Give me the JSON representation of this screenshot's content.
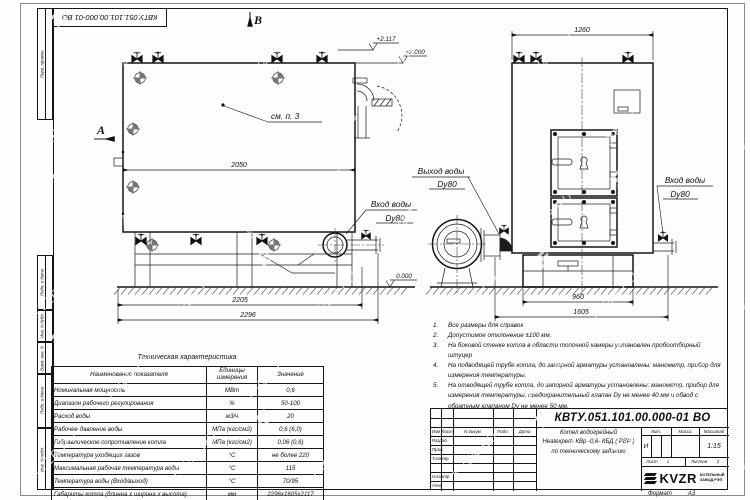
{
  "watermark": {
    "text": "KVZR.RU"
  },
  "frame": {
    "top_stamp": "КВТУ.051.101.00.000-01 ВО",
    "margin_stamps": [
      {
        "label": "Перв. примен."
      },
      {
        "label": "Подп. и дата"
      },
      {
        "label": "Инв. N дубл."
      },
      {
        "label": "Взам. инв. N"
      },
      {
        "label": "Подп. и дата"
      },
      {
        "label": "Инв. N подл."
      }
    ],
    "format_label": "Формат",
    "format_value": "А3"
  },
  "drawing": {
    "view_arrow_a": "А",
    "view_arrow_b": "В",
    "see_note": "см. п. 3",
    "elev_top": "+2.117",
    "elev_mid": "+2.000",
    "elev_zero": "0.000",
    "dims": {
      "d2050": "2050",
      "d2205": "2205",
      "d2296": "2296",
      "d1260": "1260",
      "d960": "960",
      "d1605": "1605"
    },
    "labels": {
      "outlet_line1": "Выход воды",
      "outlet_line2": "Dy80",
      "inlet_left_line1": "Вход воды",
      "inlet_left_line2": "Dy80",
      "inlet_right_line1": "Вход воды",
      "inlet_right_line2": "Dy80"
    }
  },
  "tech_table": {
    "title": "Техническая характеристика",
    "headers": {
      "name": "Наименование показателя",
      "units": "Единицы измерения",
      "value": "Значение"
    },
    "rows": [
      {
        "name": "Номинальная мощность",
        "units": "МВт",
        "value": "0,6"
      },
      {
        "name": "Диапазон рабочего регулирования",
        "units": "%",
        "value": "50-100"
      },
      {
        "name": "Расход воды",
        "units": "м3/ч",
        "value": "20"
      },
      {
        "name": "Рабочее давление воды",
        "units": "МПа (кгс/см2)",
        "value": "0,6 (6,0)"
      },
      {
        "name": "Гидравлическое сопротивление котла",
        "units": "МПа (кгс/см2)",
        "value": "0,06 (0,6)"
      },
      {
        "name": "Температура уходящих газов",
        "units": "°С",
        "value": "не более 220"
      },
      {
        "name": "Максимальная рабочая температура воды",
        "units": "°С",
        "value": "115"
      },
      {
        "name": "Температура воды (Вход/выход)",
        "units": "°С",
        "value": "70/95"
      },
      {
        "name": "Габариты котла (длинна х ширина х высота)",
        "units": "мм",
        "value": "2296х1605х2117"
      }
    ]
  },
  "notes": [
    {
      "n": "1.",
      "text": "Все размеры для справок"
    },
    {
      "n": "2.",
      "text": "Допустимое отклонение  ±100 мм."
    },
    {
      "n": "3.",
      "text": "На боковой стенке котла в области топочной камеры установлен пробоотборный штуцер"
    },
    {
      "n": "4.",
      "text": "На подводящей трубе котла, до запорной арматуры установлены: манометр, прибор для измерения температуры."
    },
    {
      "n": "5.",
      "text": "На отводящей трубе котла, до запорной арматуры установлены: манометр, прибор для измерения температуры, предохранительный клапан Dy не менее 40 мм и обвод с обратным клапаном Dy не менее 50 мм."
    }
  ],
  "title_block": {
    "doc_number": "КВТУ.051.101.00.000-01 ВО",
    "rev_headers": {
      "izm": "Изм",
      "list": "Лист",
      "ndoc": "N докум.",
      "podp": "Подп.",
      "data": "Дата"
    },
    "row_labels": {
      "razrab": "Разраб.",
      "prov": "Пров.",
      "tkontr": "Т.контр.",
      "nkontr": "Н.контр",
      "utv": "Утв."
    },
    "title_line1": "Котел водогрейный",
    "title_line2": "Heatexpert- КВр -0,6- КБД ( РВР )",
    "title_line3": "по техническому заданию",
    "lit_header": "Лит.",
    "mass_header": "Масса",
    "scale_header": "Масштаб",
    "lit_value": "И",
    "scale_value": "1:15",
    "sheet_label": "Лист",
    "sheet_value": "1",
    "sheets_label": "Листов",
    "sheets_value": "2",
    "brand_name": "KVZR",
    "brand_sub1": "КОТЕЛЬНЫЙ",
    "brand_sub2": "ЗАВОД РЭП"
  }
}
